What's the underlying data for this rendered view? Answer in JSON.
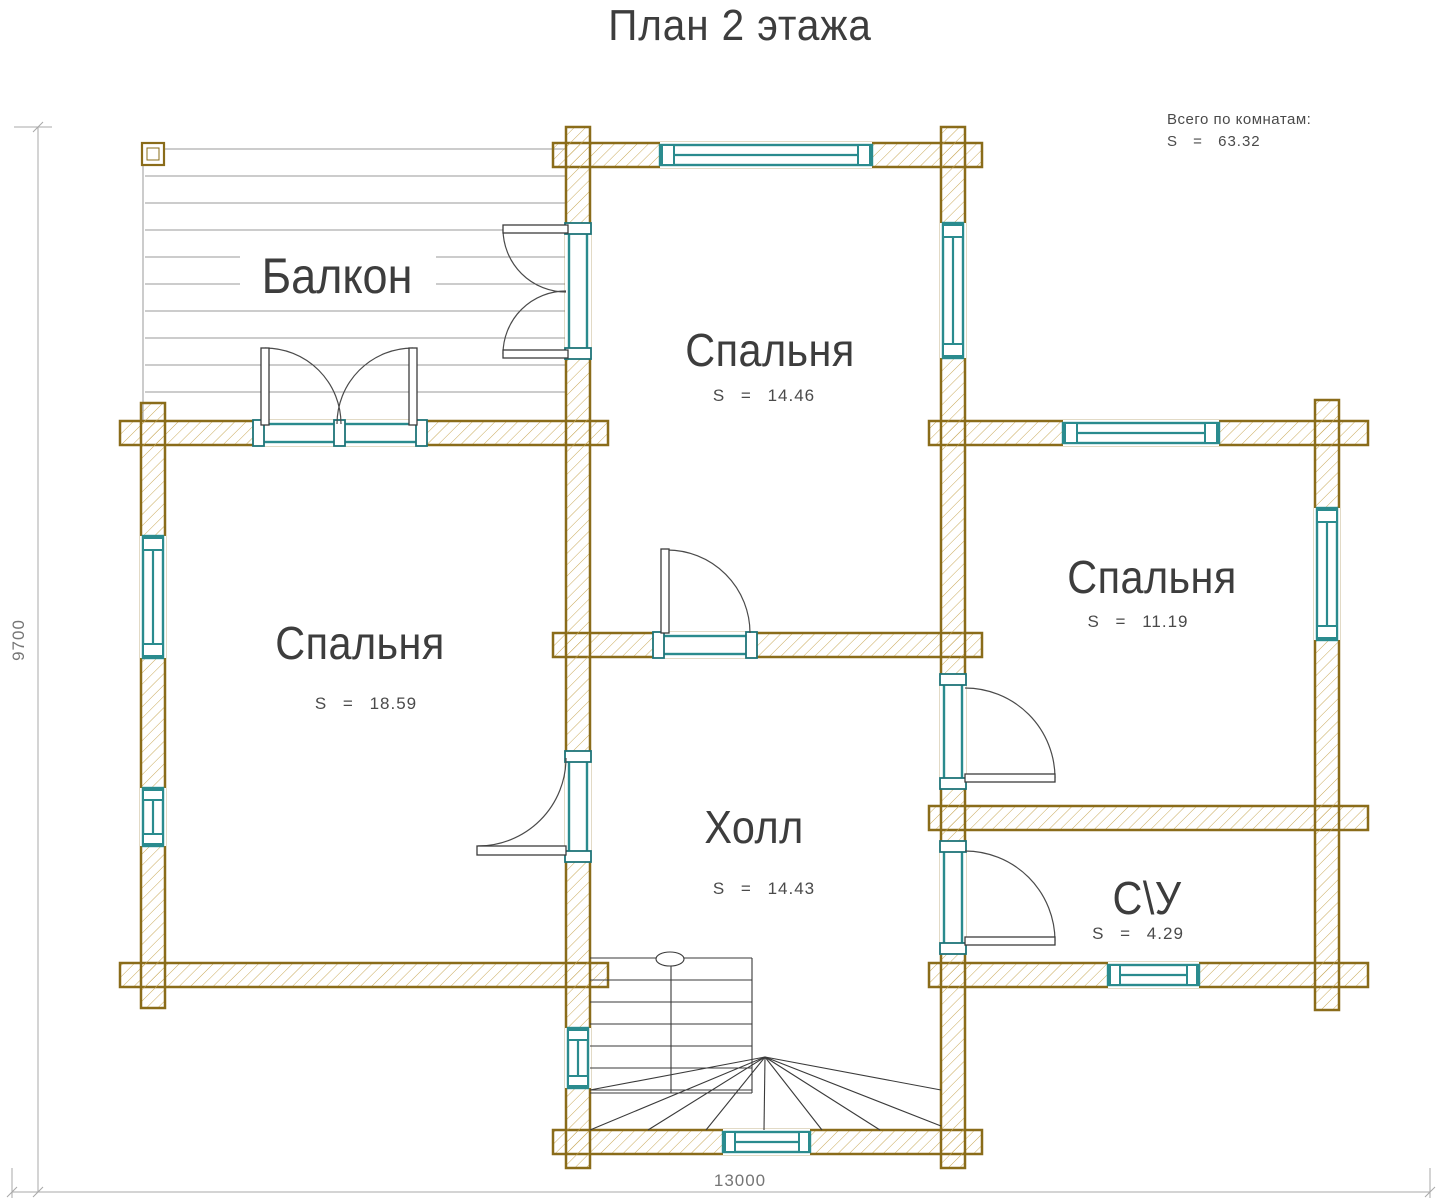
{
  "title": "План 2 этажа",
  "summary": {
    "label": "Всего по комнатам:",
    "value": "S = 63.32"
  },
  "rooms": [
    {
      "name": "Балкон",
      "area": ""
    },
    {
      "name": "Спальня",
      "area": "S = 14.46"
    },
    {
      "name": "Спальня",
      "area": "S = 18.59"
    },
    {
      "name": "Спальня",
      "area": "S = 11.19"
    },
    {
      "name": "Холл",
      "area": "S = 14.43"
    },
    {
      "name": "С\\У",
      "area": "S = 4.29"
    }
  ],
  "dimensions": {
    "width_mm": "13000",
    "height_mm": "9700"
  },
  "colors": {
    "wall_outline": "#8a6c1a",
    "wall_hatch": "#c9a959",
    "window_frame": "#2a8b8e",
    "label_text": "#3d3d3d",
    "dimension_text": "#757575"
  }
}
